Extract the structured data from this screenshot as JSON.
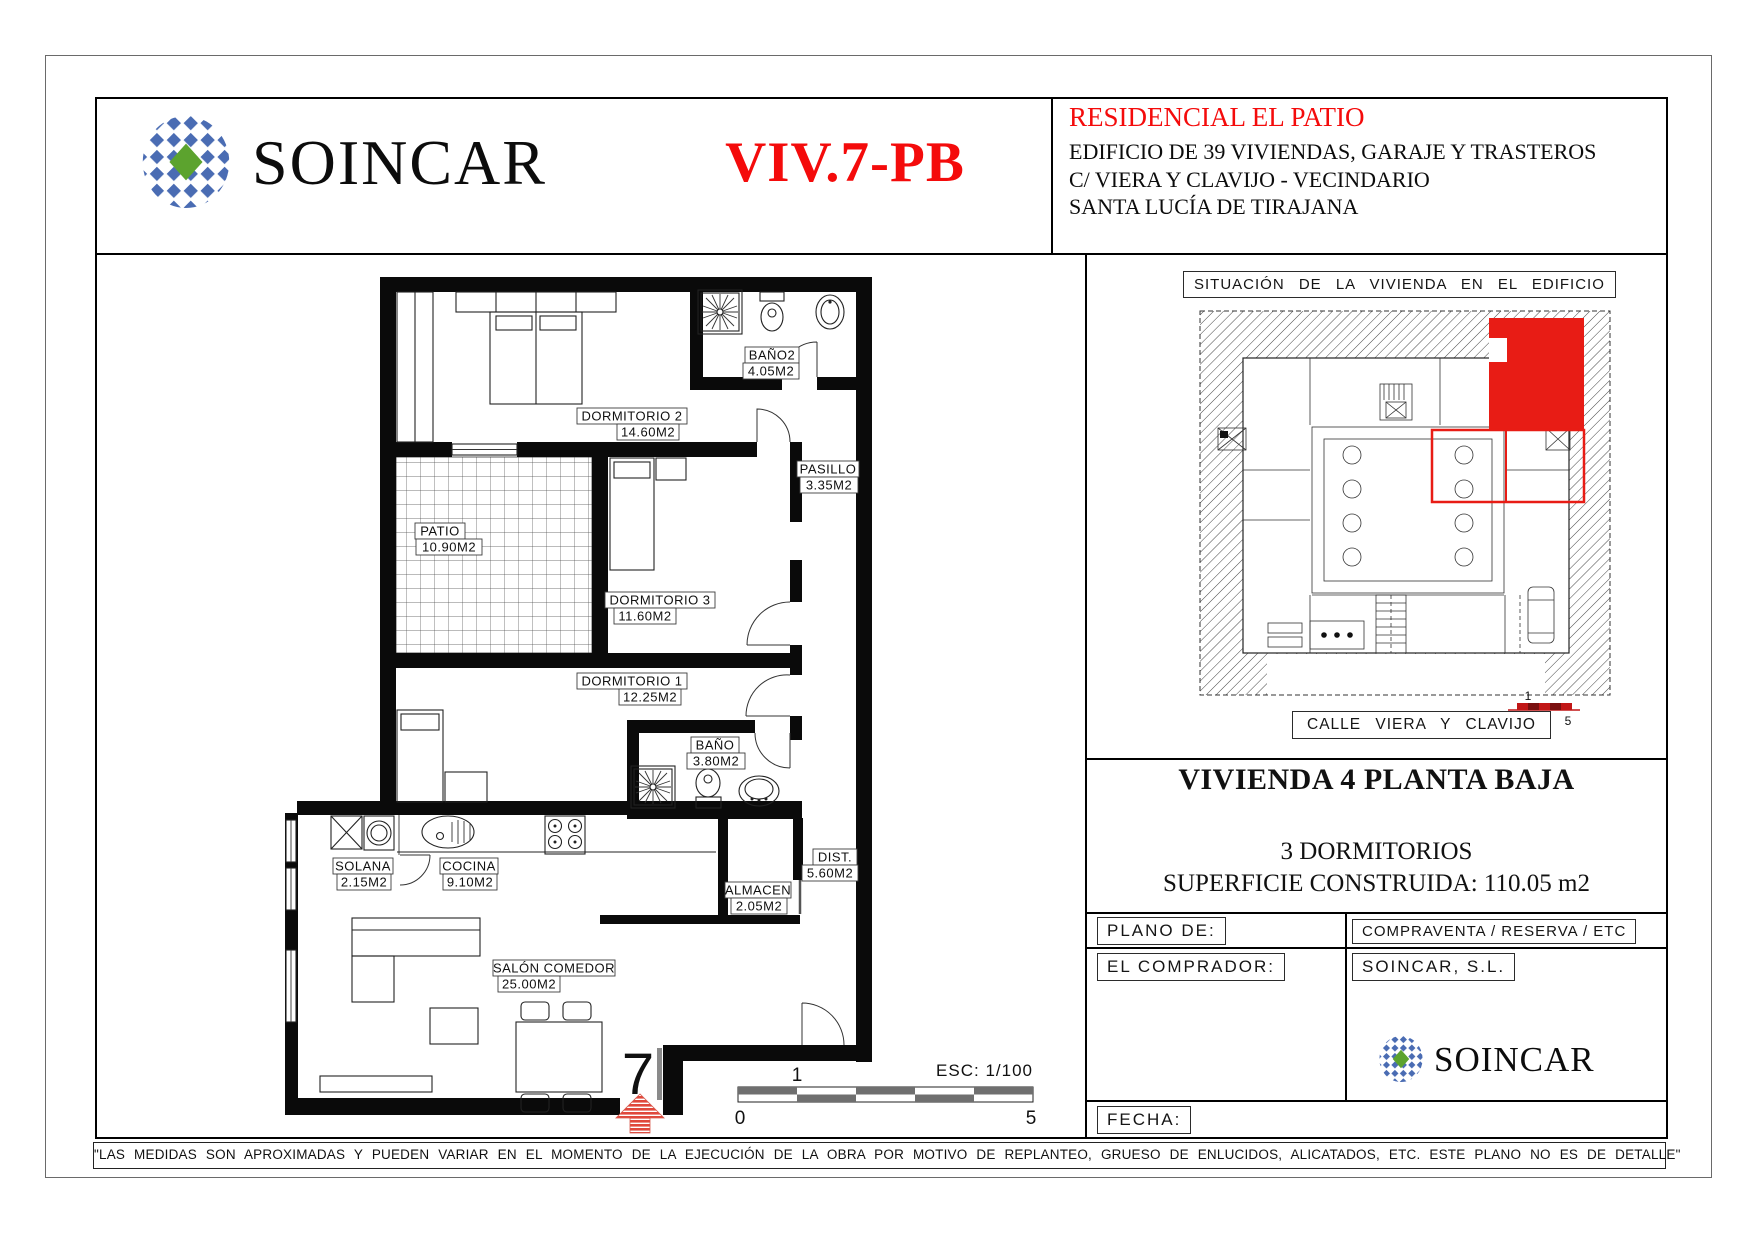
{
  "header": {
    "brand": "SOINCAR",
    "unit_code": "VIV.7-PB",
    "project": {
      "title": "RESIDENCIAL EL PATIO",
      "line1": "EDIFICIO DE 39 VIVIENDAS, GARAJE Y TRASTEROS",
      "line2": "C/ VIERA Y CLAVIJO - VECINDARIO",
      "line3": "SANTA LUCÍA DE TIRAJANA"
    }
  },
  "plan": {
    "rooms": [
      {
        "name": "BAÑO2",
        "area": "4.05M2"
      },
      {
        "name": "DORMITORIO  2",
        "area": "14.60M2"
      },
      {
        "name": "PASILLO",
        "area": "3.35M2"
      },
      {
        "name": "PATIO",
        "area": "10.90M2"
      },
      {
        "name": "DORMITORIO  3",
        "area": "11.60M2"
      },
      {
        "name": "DORMITORIO  1",
        "area": "12.25M2"
      },
      {
        "name": "BAÑO",
        "area": "3.80M2"
      },
      {
        "name": "SOLANA",
        "area": "2.15M2"
      },
      {
        "name": "COCINA",
        "area": "9.10M2"
      },
      {
        "name": "ALMACEN",
        "area": "2.05M2"
      },
      {
        "name": "DIST.",
        "area": "5.60M2"
      },
      {
        "name": "SALÓN  COMEDOR",
        "area": "25.00M2"
      }
    ],
    "entrance_number": "7",
    "scale": {
      "label": "ESC: 1/100",
      "tick0": "0",
      "tick1": "1",
      "tick5": "5"
    }
  },
  "situation": {
    "title": "SITUACIÓN DE LA VIVIENDA EN EL EDIFICIO",
    "street": "CALLE VIERA Y CLAVIJO",
    "scale": {
      "tick0": "0",
      "tick1": "1",
      "tick5": "5"
    }
  },
  "info": {
    "dwelling_title": "VIVIENDA 4  PLANTA BAJA",
    "bedrooms": "3 DORMITORIOS",
    "surface": "SUPERFICIE CONSTRUIDA: 110.05 m2",
    "plano_de": "PLANO DE:",
    "plan_type": "COMPRAVENTA / RESERVA / ETC",
    "buyer_label": "EL COMPRADOR:",
    "company": "SOINCAR, S.L.",
    "brand": "SOINCAR",
    "fecha_label": "FECHA:"
  },
  "footer": {
    "disclaimer": "\"LAS MEDIDAS SON APROXIMADAS Y PUEDEN VARIAR EN EL MOMENTO DE LA EJECUCIÓN DE LA OBRA POR MOTIVO DE REPLANTEO, GRUESO DE ENLUCIDOS, ALICATADOS, ETC. ESTE PLANO NO ES DE DETALLE\""
  },
  "colors": {
    "accent_red": "#f40b0b",
    "unit_red": "#e81c15",
    "brand_blue": "#4a6cb3",
    "brand_green": "#5ca32e"
  }
}
